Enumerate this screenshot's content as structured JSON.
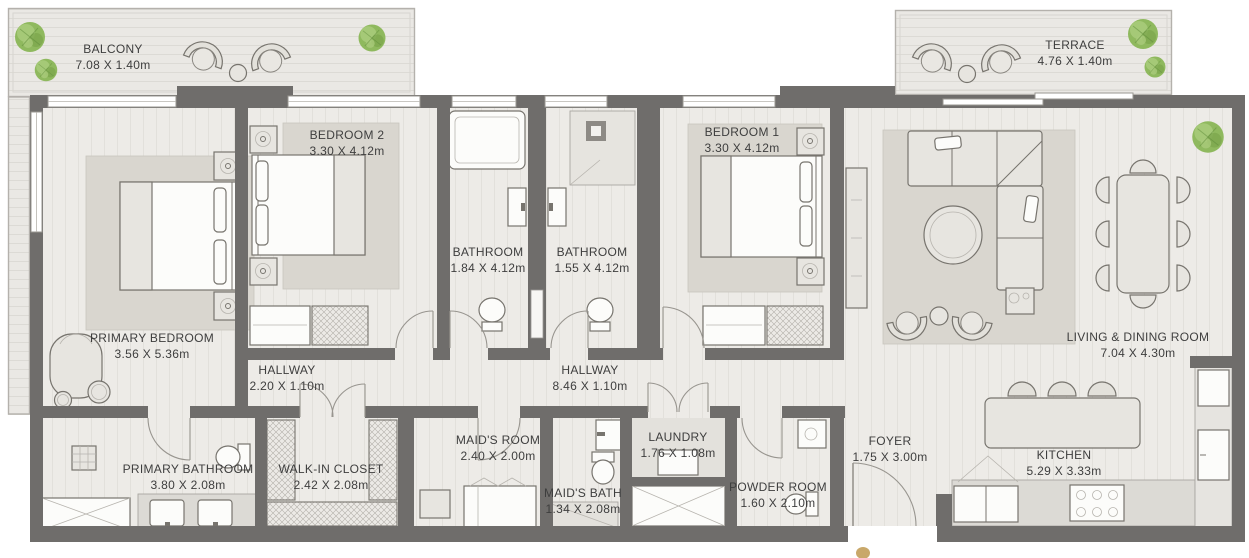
{
  "plan_type": "apartment-floor-plan",
  "rooms": [
    {
      "id": "balcony",
      "name": "BALCONY",
      "dims": "7.08 X 1.40m"
    },
    {
      "id": "terrace",
      "name": "TERRACE",
      "dims": "4.76 X 1.40m"
    },
    {
      "id": "bedroom-2",
      "name": "BEDROOM 2",
      "dims": "3.30 X 4.12m"
    },
    {
      "id": "bathroom-a",
      "name": "BATHROOM",
      "dims": "1.84 X 4.12m"
    },
    {
      "id": "bathroom-b",
      "name": "BATHROOM",
      "dims": "1.55 X 4.12m"
    },
    {
      "id": "bedroom-1",
      "name": "BEDROOM 1",
      "dims": "3.30 X 4.12m"
    },
    {
      "id": "primary-bedroom",
      "name": "PRIMARY BEDROOM",
      "dims": "3.56 X 5.36m"
    },
    {
      "id": "hallway-a",
      "name": "HALLWAY",
      "dims": "2.20 X 1.10m"
    },
    {
      "id": "hallway-b",
      "name": "HALLWAY",
      "dims": "8.46 X 1.10m"
    },
    {
      "id": "living-dining",
      "name": "LIVING & DINING ROOM",
      "dims": "7.04 X 4.30m"
    },
    {
      "id": "primary-bathroom",
      "name": "PRIMARY BATHROOM",
      "dims": "3.80 X 2.08m"
    },
    {
      "id": "walk-in-closet",
      "name": "WALK-IN CLOSET",
      "dims": "2.42 X 2.08m"
    },
    {
      "id": "maids-room",
      "name": "MAID'S ROOM",
      "dims": "2.40 X 2.00m"
    },
    {
      "id": "maids-bath",
      "name": "MAID'S BATH",
      "dims": "1.34 X 2.08m"
    },
    {
      "id": "laundry",
      "name": "LAUNDRY",
      "dims": "1.76 X 1.08m"
    },
    {
      "id": "powder-room",
      "name": "POWDER ROOM",
      "dims": "1.60 X 2.10m"
    },
    {
      "id": "foyer",
      "name": "FOYER",
      "dims": "1.75 X 3.00m"
    },
    {
      "id": "kitchen",
      "name": "KITCHEN",
      "dims": "5.29 X 3.33m"
    }
  ],
  "colors": {
    "wall": "#6f6d6b",
    "floor": "#edebe7",
    "outfloor": "#eae8e4",
    "rug": "#d9d6cf",
    "furn": "#e7e5e0",
    "stroke": "#77746e",
    "text": "#3e3e3e",
    "accent": "#c9a86a",
    "bg": "#ffffff"
  }
}
